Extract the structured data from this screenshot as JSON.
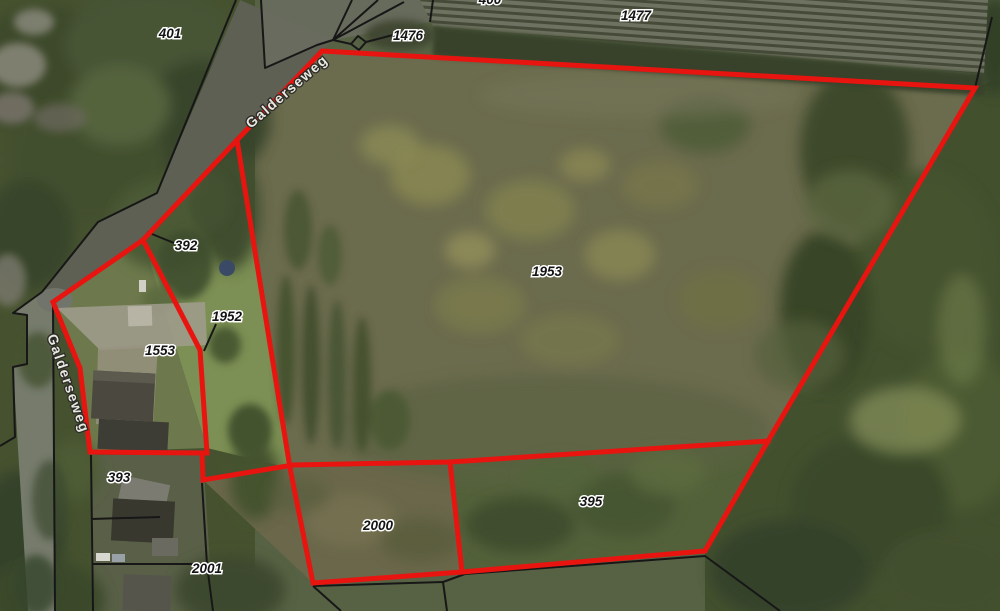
{
  "map": {
    "kind": "aerial-cadastral-view",
    "colors": {
      "selection_outline_red": "#e81410",
      "cadastral_boundary_black": "#171717",
      "label_text": "#141414",
      "label_halo": "#ffffff",
      "street_label_fill": "#e9e8e0"
    },
    "parcel_labels": [
      {
        "id": "401"
      },
      {
        "id": "400"
      },
      {
        "id": "1476"
      },
      {
        "id": "1477"
      },
      {
        "id": "392"
      },
      {
        "id": "1952"
      },
      {
        "id": "1553"
      },
      {
        "id": "1953"
      },
      {
        "id": "393"
      },
      {
        "id": "2000"
      },
      {
        "id": "395"
      },
      {
        "id": "2001"
      }
    ],
    "street_labels": [
      {
        "text": "Galderseweg"
      },
      {
        "text": "Galderseweg"
      }
    ]
  }
}
